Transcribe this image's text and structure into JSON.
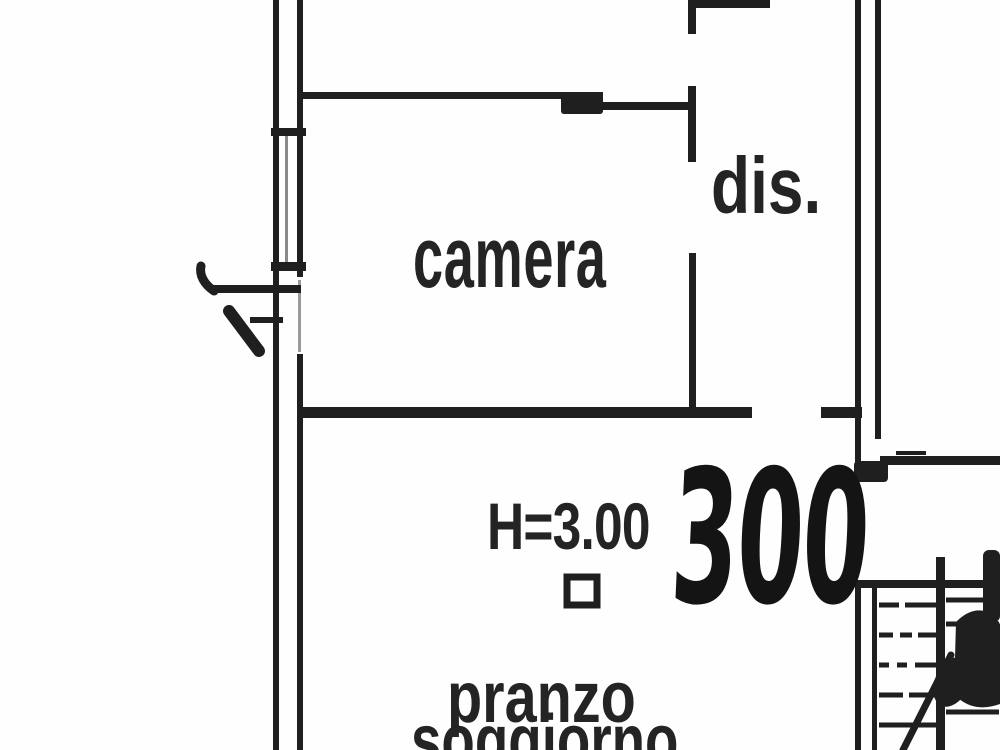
{
  "colors": {
    "ink": "#1f1f1f",
    "ink_soft": "#8a8a8a",
    "paper": "#fefefe"
  },
  "rooms": {
    "camera": {
      "label": "camera"
    },
    "dis": {
      "label": "dis."
    },
    "pranzo_soggiorno": {
      "label_line1": "pranzo",
      "label_line2": "soggiorno"
    }
  },
  "annotations": {
    "ceiling_height": {
      "text": "H=3.00"
    },
    "handwritten_note": {
      "text": "300"
    }
  }
}
